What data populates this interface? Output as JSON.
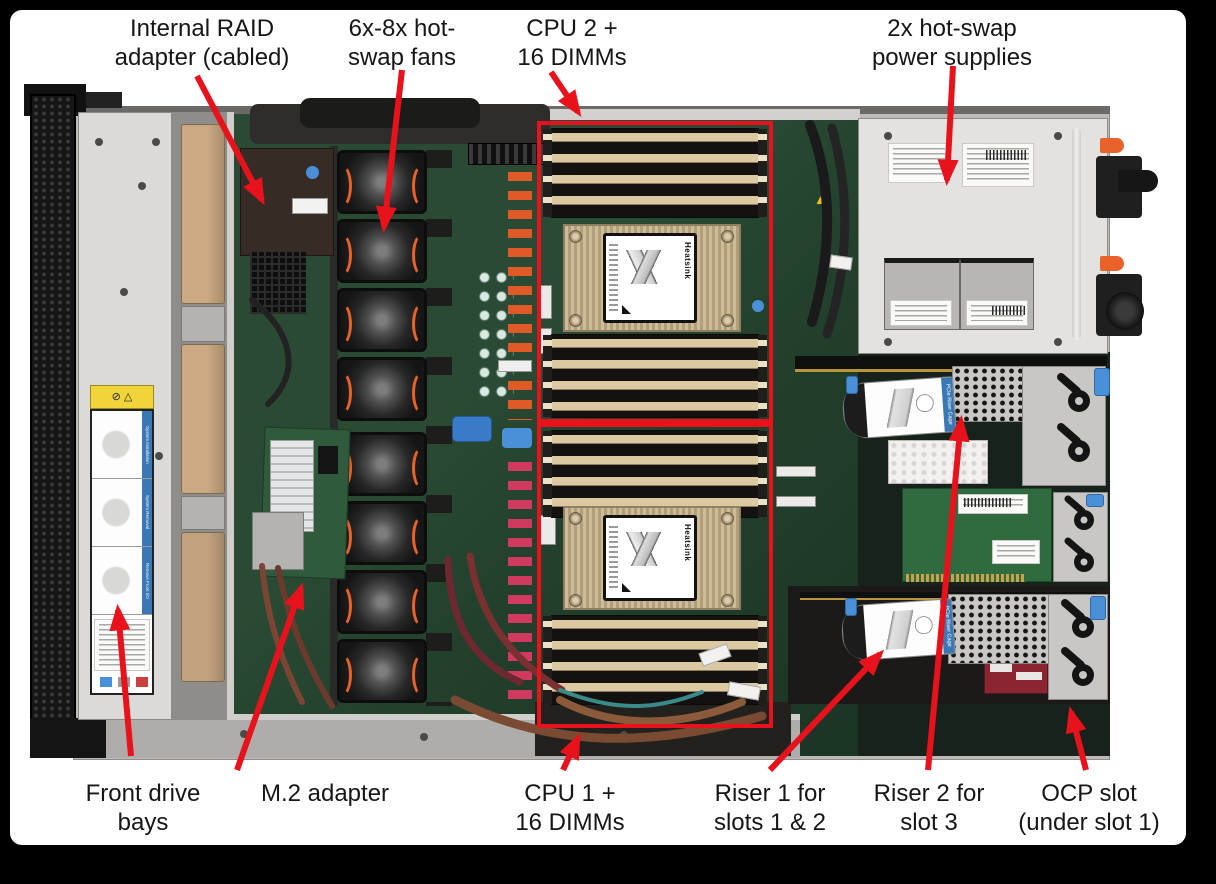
{
  "colors": {
    "annotation_red": "#e8121d",
    "board_green": "#26452f",
    "chassis_gray": "#bdbbb8",
    "psu_bay_gray": "#e3e2df",
    "dimm_tan": "#dbc9a1",
    "heatsink_champagne": "#c8b593",
    "accent_orange": "#e8622a",
    "accent_blue": "#4a90d9",
    "ocp_card_red": "#8c2532"
  },
  "callouts": [
    {
      "id": "internal-raid-adapter",
      "lines": [
        "Internal RAID",
        "adapter (cabled)"
      ]
    },
    {
      "id": "hot-swap-fans",
      "lines": [
        "6x-8x hot-",
        "swap fans"
      ]
    },
    {
      "id": "cpu2-dimms",
      "lines": [
        "CPU 2 +",
        "16 DIMMs"
      ]
    },
    {
      "id": "power-supplies",
      "lines": [
        "2x hot-swap",
        "power supplies"
      ]
    },
    {
      "id": "front-drive-bays",
      "lines": [
        "Front drive",
        "bays"
      ]
    },
    {
      "id": "m2-adapter",
      "lines": [
        "M.2 adapter"
      ]
    },
    {
      "id": "cpu1-dimms",
      "lines": [
        "CPU 1 +",
        "16 DIMMs"
      ]
    },
    {
      "id": "riser1",
      "lines": [
        "Riser 1 for",
        "slots 1 & 2"
      ]
    },
    {
      "id": "riser2",
      "lines": [
        "Riser 2 for",
        "slot 3"
      ]
    },
    {
      "id": "ocp-slot",
      "lines": [
        "OCP slot",
        "(under slot 1)"
      ]
    }
  ],
  "photo_text": {
    "heatsink_label": "Heatsink",
    "riser_cage_label": "PCIe Riser Cage",
    "service_strip_labels": [
      "System Installation",
      "System Removal",
      "Remove Front I/O"
    ]
  }
}
